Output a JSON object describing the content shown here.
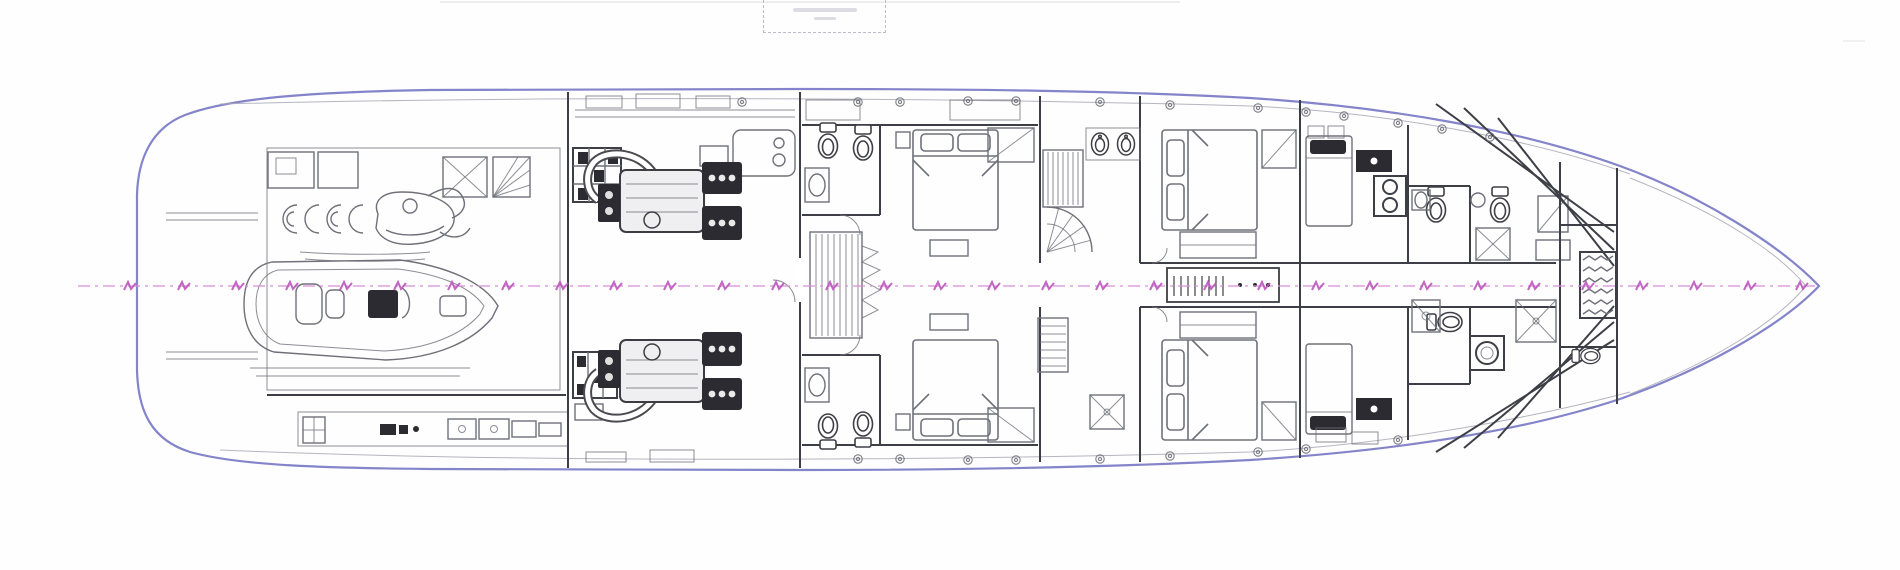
{
  "title_box": {
    "line1": "",
    "line2": ""
  },
  "colors": {
    "background": "#fefefe",
    "hull-outline": "#8484ca",
    "deck-line": "#a8a8b6",
    "linework": "#70707a",
    "wall-dark": "#3e3e46",
    "fixture-dark": "#2b2b31",
    "centerline": "#d98fd9",
    "station-marker": "#bb55bb",
    "titlebox-border": "#bcbcc6",
    "faint-artifact": "#e8e8ec"
  },
  "centerline": {
    "y": 286,
    "x_start": 78,
    "x_end": 1819,
    "stations": [
      130,
      184,
      238,
      292,
      346,
      400,
      454,
      508,
      562,
      616,
      670,
      724,
      778,
      832,
      886,
      940,
      994,
      1048,
      1102,
      1156,
      1210,
      1264,
      1318,
      1372,
      1426,
      1480,
      1534,
      1588,
      1642,
      1696,
      1750,
      1802
    ]
  },
  "portholes": {
    "top": [
      [
        742,
        102
      ],
      [
        858,
        102
      ],
      [
        900,
        102
      ],
      [
        968,
        101
      ],
      [
        1016,
        101
      ],
      [
        1100,
        102
      ],
      [
        1170,
        105
      ],
      [
        1258,
        108
      ],
      [
        1306,
        112
      ],
      [
        1344,
        116
      ],
      [
        1398,
        123
      ],
      [
        1442,
        129
      ],
      [
        1490,
        137
      ]
    ],
    "bottom": [
      [
        858,
        459
      ],
      [
        900,
        459
      ],
      [
        968,
        460
      ],
      [
        1016,
        460
      ],
      [
        1100,
        459
      ],
      [
        1170,
        456
      ],
      [
        1258,
        452
      ],
      [
        1306,
        449
      ],
      [
        1398,
        440
      ]
    ]
  }
}
